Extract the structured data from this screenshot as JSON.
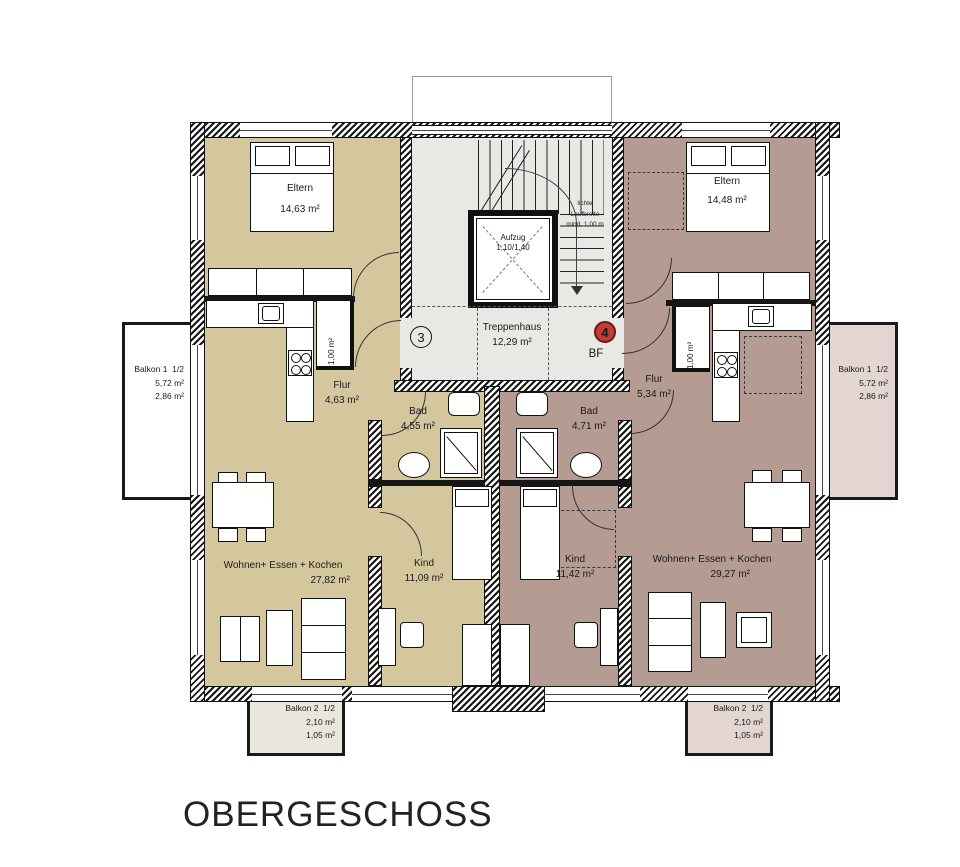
{
  "title": "OBERGESCHOSS",
  "colors": {
    "apartment_left_fill": "#d4c79e",
    "apartment_right_fill": "#b59c93",
    "stairwell_fill": "#e8e8e5",
    "balcony_pink_fill": "#e3d5d1",
    "balcony_beige_fill": "#e9e7dc",
    "marker_red": "#c43c35"
  },
  "stairwell": {
    "room_name": "Treppenhaus",
    "room_area": "12,29 m²",
    "elevator_name": "Aufzug",
    "elevator_dims": "1,10/1,40",
    "note_line1": "lichte",
    "note_line2": "Laufbreite",
    "note_line3": "mind. 1,00 m",
    "bf_label": "BF",
    "unit_left_number": "3",
    "unit_right_number": "4"
  },
  "apartment_left": {
    "eltern_name": "Eltern",
    "eltern_area": "14,63 m²",
    "flur_name": "Flur",
    "flur_area": "4,63 m²",
    "bad_name": "Bad",
    "bad_area": "4,55 m²",
    "kind_name": "Kind",
    "kind_area": "11,09 m²",
    "wohnen_name": "Wohnen+ Essen + Kochen",
    "wohnen_area": "27,82 m²",
    "closet_area": "1,00 m²",
    "balkon1_name": "Balkon 1",
    "balkon1_fraction": "1/2",
    "balkon1_area": "5,72 m²",
    "balkon1_half_area": "2,86 m²",
    "balkon2_name": "Balkon 2",
    "balkon2_fraction": "1/2",
    "balkon2_area": "2,10 m²",
    "balkon2_half_area": "1,05 m²"
  },
  "apartment_right": {
    "eltern_name": "Eltern",
    "eltern_area": "14,48 m²",
    "flur_name": "Flur",
    "flur_area": "5,34 m²",
    "bad_name": "Bad",
    "bad_area": "4,71 m²",
    "kind_name": "Kind",
    "kind_area": "11,42 m²",
    "wohnen_name": "Wohnen+ Essen + Kochen",
    "wohnen_area": "29,27 m²",
    "closet_area": "1,00 m²",
    "balkon1_name": "Balkon 1",
    "balkon1_fraction": "1/2",
    "balkon1_area": "5,72 m²",
    "balkon1_half_area": "2,86 m²",
    "balkon2_name": "Balkon 2",
    "balkon2_fraction": "1/2",
    "balkon2_area": "2,10 m²",
    "balkon2_half_area": "1,05 m²"
  }
}
